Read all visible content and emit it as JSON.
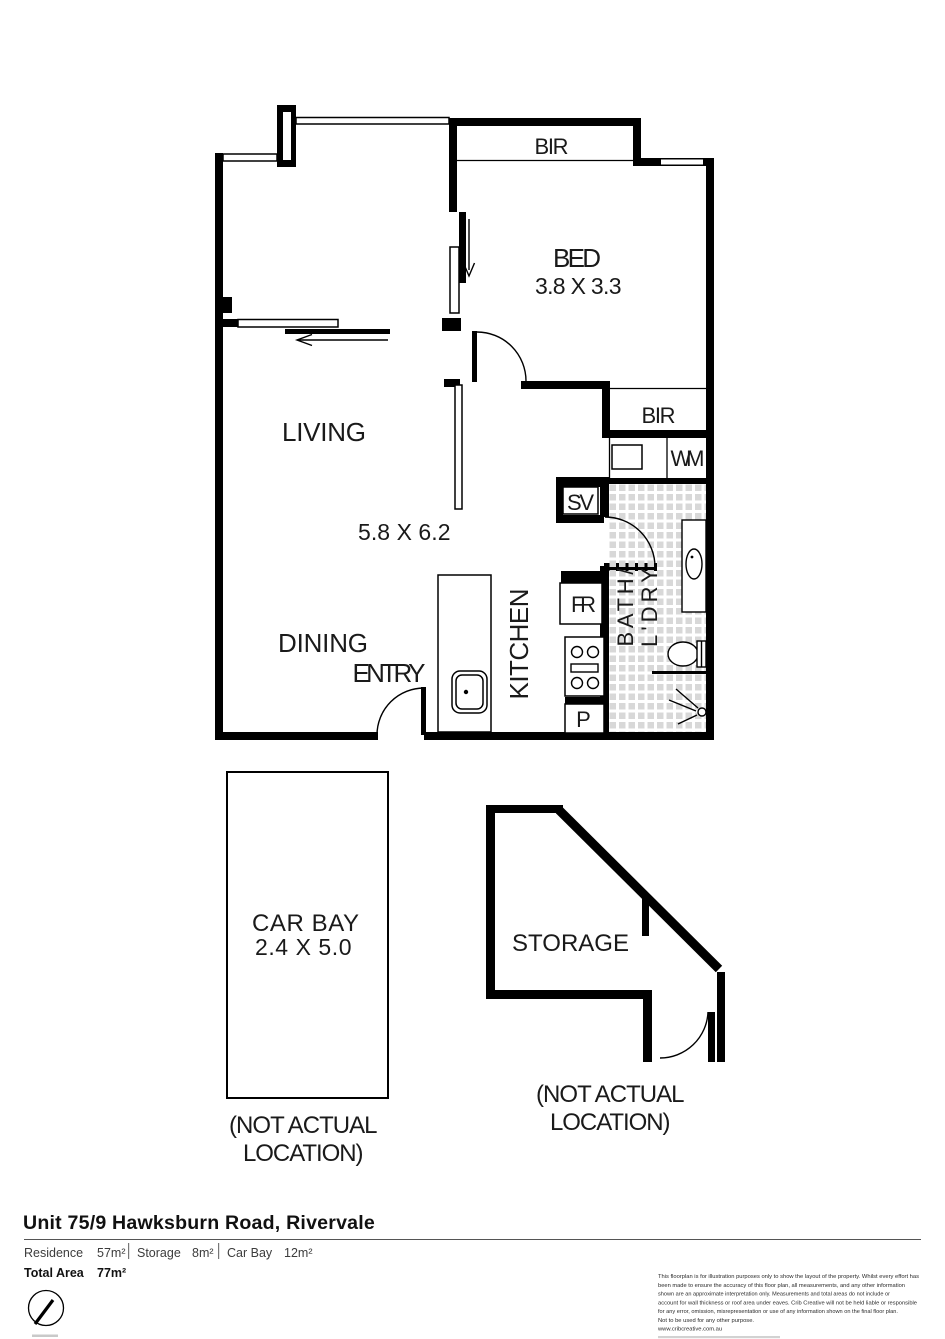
{
  "plan": {
    "bed": {
      "label": "BED",
      "dims": "3.8 X 3.3",
      "bir": "BIR"
    },
    "living": {
      "label": "LIVING",
      "dims": "5.8 X 6.2"
    },
    "dining": {
      "label": "DINING"
    },
    "entry": {
      "label": "ENTRY"
    },
    "kitchen": {
      "label": "KITCHEN",
      "fridge": "FR",
      "pantry": "P",
      "service": "SV"
    },
    "bath": {
      "line1": "BATH/",
      "line2": "L'DRY",
      "bir": "BIR",
      "washer": "WM"
    },
    "carbay": {
      "label": "CAR BAY",
      "dims": "2.4 X 5.0",
      "note1": "(NOT ACTUAL",
      "note2": "LOCATION)"
    },
    "storage": {
      "label": "STORAGE",
      "note1": "(NOT ACTUAL",
      "note2": "LOCATION)"
    }
  },
  "footer": {
    "title": "Unit 75/9 Hawksburn Road, Rivervale",
    "areas": [
      {
        "label": "Residence",
        "value": "57m²"
      },
      {
        "label": "Storage",
        "value": "8m²"
      },
      {
        "label": "Car Bay",
        "value": "12m²"
      }
    ],
    "total_label": "Total Area",
    "total_value": "77m²",
    "disclaimer": [
      "This floorplan is for illustration purposes only to show the layout of the property. Whilst every effort has",
      "been made to ensure the accuracy of this floor plan, all measurements, and any other information",
      "shown are an approximate interpretation only. Measurements and total areas do not include or",
      "account for wall thickness or roof area under eaves. Crib Creative will not be held liable or responsible",
      "for any error, omission, misrepresentation or use of any information shown on the final floor plan.",
      "Not to be used for any other purpose."
    ],
    "website": "www.cribcreative.com.au"
  },
  "colors": {
    "wall": "#000000",
    "tile": "#d8d8d8",
    "text": "#1a1a1a"
  }
}
